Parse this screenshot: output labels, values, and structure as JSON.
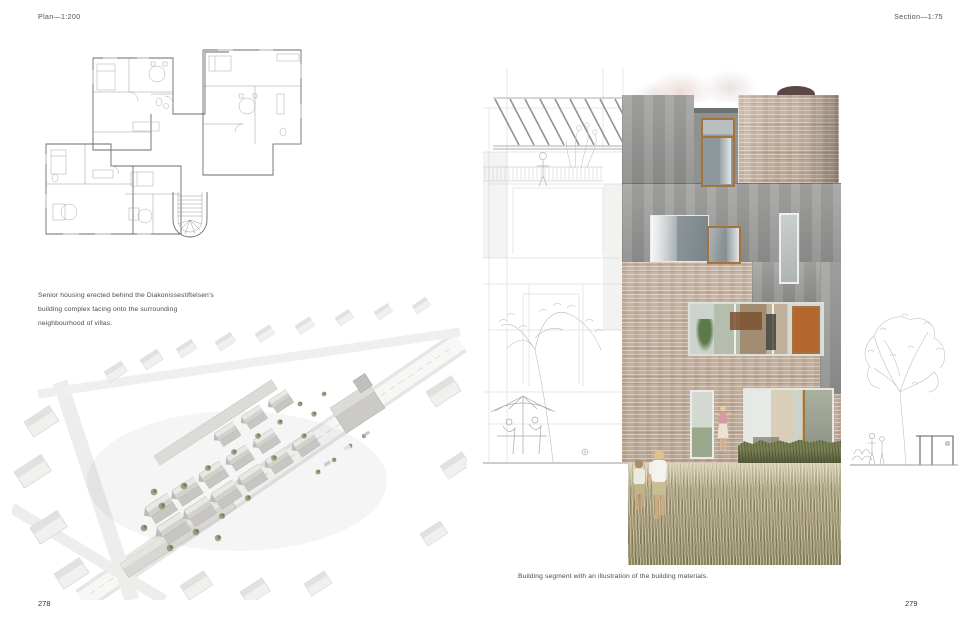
{
  "spread": {
    "left": {
      "header": "Plan—1:200",
      "caption_lines": [
        "Senior housing erected behind the Diakonissestiftelsen's",
        "building complex facing onto the surrounding",
        "neighbourhood of villas."
      ],
      "page_number": "278"
    },
    "right": {
      "header": "Section—1:75",
      "caption": "Building segment with an illustration of the building materials.",
      "page_number": "279"
    }
  },
  "palette": {
    "zinc": "#9c9c9a",
    "brick": "#c4b2a1",
    "wood": "#a5733c",
    "dome": "#5c4743",
    "hedge": "#5e6440",
    "grass": "#a59d7d",
    "tree-green": "#8e9672",
    "interior-warm": "#b4662e",
    "line-art": "#c6c6c6"
  }
}
